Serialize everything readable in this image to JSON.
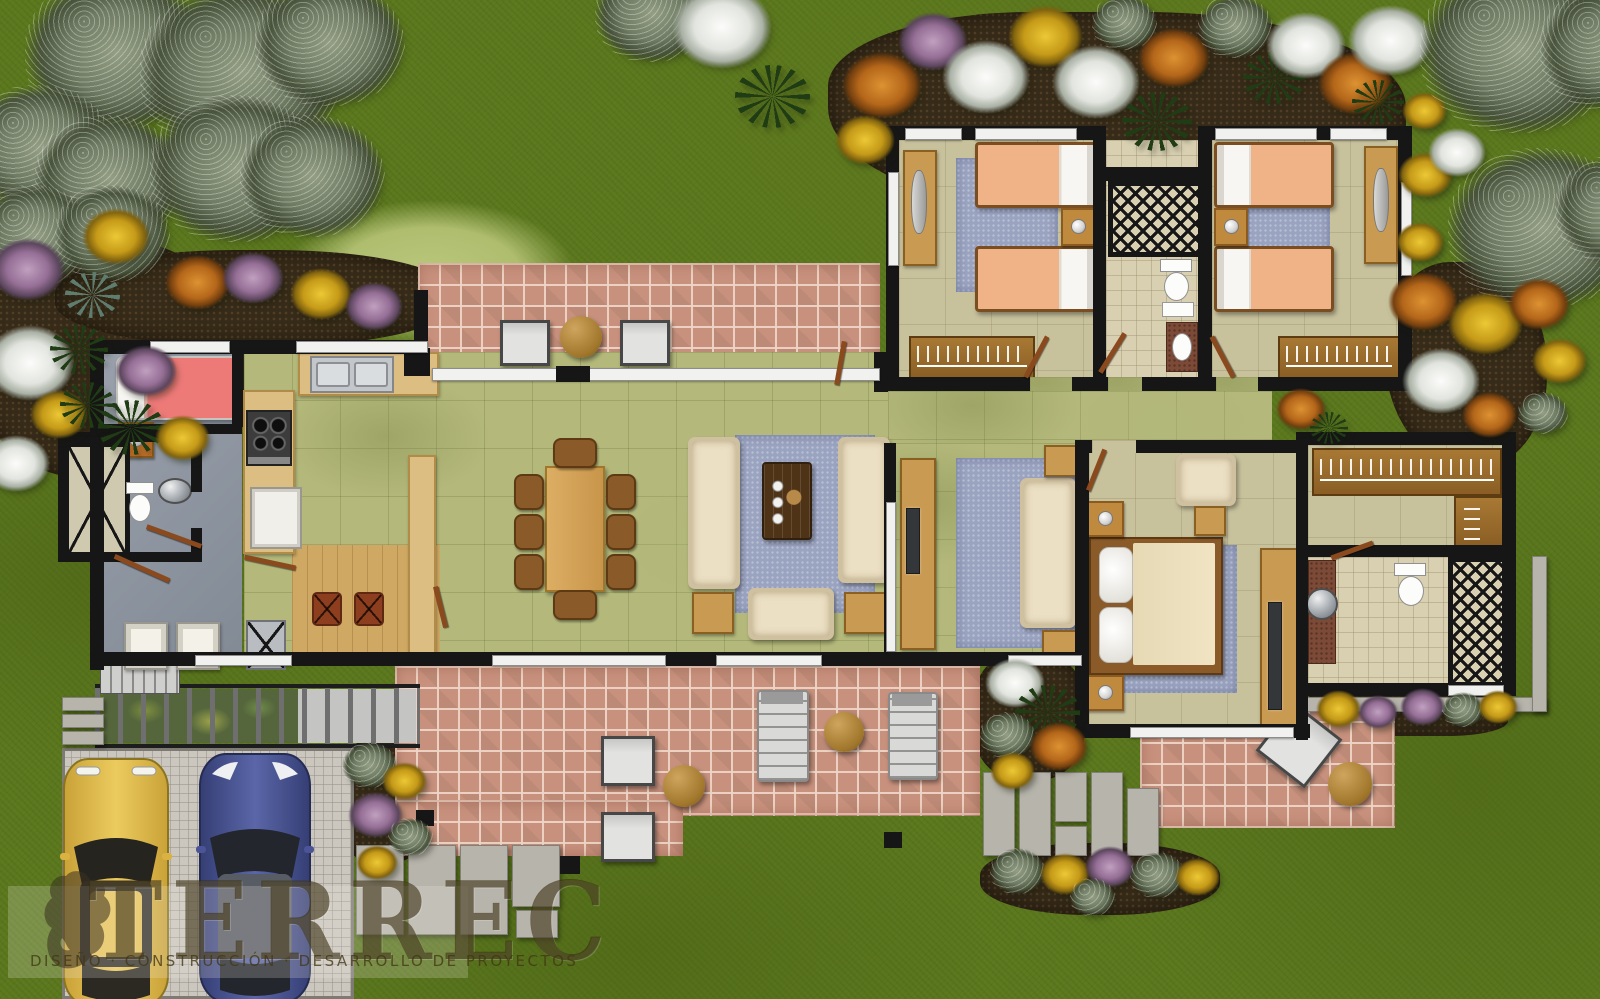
{
  "logo": {
    "title": "TERREC",
    "subtitle": "Diseño · Construcción · Desarrollo de Proyectos"
  },
  "palette": {
    "grass": "#5d7a1f",
    "grass_dark": "#4a6315",
    "hill": "#b2c173",
    "soil": "#362a18",
    "sage": "#75816a",
    "white_bloom": "#eceeea",
    "orange_bloom": "#c1771f",
    "yellow_bloom": "#d3a91d",
    "purple_bloom": "#a480a6",
    "palm": "#1f3c14",
    "wall": "#161616",
    "brick": "#c7917d",
    "mortar": "#ead0c0",
    "tile": "#b4b97b",
    "khaki": "#c7c19c",
    "bath": "#d9d0b2",
    "grayfloor": "#8e95a0",
    "wood": "#c89a52",
    "wood_dark": "#8a5a28",
    "closet_wood": "#9c6c30",
    "counter": "#ddbe82",
    "rug": "#9aa3c0",
    "sofa": "#ece0c4",
    "bed_peach": "#f0b287",
    "bed_pink": "#ee7a78",
    "bed_cream": "#f0e4c4",
    "steel": "#c3c6ca",
    "chair_gray": "#d2d2d2",
    "drive": "#cbc7bf",
    "paver": "#b7b4ac",
    "car_yellow": "#e2bc4a",
    "car_blue": "#4a5596",
    "logo_ink": "#3e3014"
  },
  "flora": [
    [
      25,
      -25,
      185,
      "sage"
    ],
    [
      140,
      -15,
      205,
      "sage"
    ],
    [
      255,
      -20,
      150,
      "sage"
    ],
    [
      -35,
      85,
      150,
      "sage"
    ],
    [
      35,
      115,
      150,
      "sage"
    ],
    [
      150,
      95,
      175,
      "sage"
    ],
    [
      240,
      115,
      145,
      "sage"
    ],
    [
      -25,
      185,
      120,
      "sage"
    ],
    [
      55,
      185,
      115,
      "sage"
    ],
    [
      595,
      -35,
      115,
      "sage"
    ],
    [
      672,
      -15,
      100,
      "white"
    ],
    [
      735,
      65,
      75,
      "palm"
    ],
    [
      842,
      52,
      80,
      "orange"
    ],
    [
      835,
      115,
      60,
      "yellow"
    ],
    [
      898,
      12,
      70,
      "purple"
    ],
    [
      942,
      40,
      88,
      "white"
    ],
    [
      1008,
      5,
      75,
      "yellow"
    ],
    [
      1052,
      45,
      88,
      "white"
    ],
    [
      1092,
      -5,
      65,
      "sage"
    ],
    [
      1122,
      92,
      70,
      "palm"
    ],
    [
      1138,
      28,
      72,
      "orange"
    ],
    [
      1198,
      -5,
      75,
      "sage"
    ],
    [
      1243,
      52,
      62,
      "palm"
    ],
    [
      1266,
      12,
      80,
      "white"
    ],
    [
      1318,
      52,
      75,
      "orange"
    ],
    [
      1348,
      5,
      85,
      "white"
    ],
    [
      1352,
      80,
      52,
      "palm"
    ],
    [
      1402,
      92,
      45,
      "yellow"
    ],
    [
      1398,
      152,
      55,
      "yellow"
    ],
    [
      1428,
      128,
      58,
      "white"
    ],
    [
      1396,
      222,
      48,
      "yellow"
    ],
    [
      1420,
      -35,
      200,
      "sage"
    ],
    [
      1540,
      -15,
      150,
      "sage"
    ],
    [
      1448,
      148,
      190,
      "sage"
    ],
    [
      1555,
      155,
      130,
      "sage"
    ],
    [
      1388,
      272,
      70,
      "orange"
    ],
    [
      1448,
      292,
      75,
      "yellow"
    ],
    [
      1508,
      278,
      62,
      "orange"
    ],
    [
      1532,
      338,
      55,
      "yellow"
    ],
    [
      1402,
      348,
      78,
      "white"
    ],
    [
      1462,
      392,
      55,
      "orange"
    ],
    [
      1518,
      392,
      50,
      "sage"
    ],
    [
      1276,
      388,
      50,
      "orange"
    ],
    [
      1310,
      412,
      38,
      "palm"
    ],
    [
      82,
      208,
      68,
      "yellow"
    ],
    [
      -10,
      238,
      75,
      "purple"
    ],
    [
      165,
      255,
      65,
      "orange"
    ],
    [
      65,
      272,
      55,
      "agave"
    ],
    [
      222,
      252,
      62,
      "purple"
    ],
    [
      290,
      268,
      62,
      "yellow"
    ],
    [
      345,
      282,
      58,
      "purple"
    ],
    [
      -15,
      325,
      90,
      "white"
    ],
    [
      50,
      325,
      58,
      "palm"
    ],
    [
      115,
      345,
      62,
      "purple"
    ],
    [
      30,
      390,
      58,
      "yellow"
    ],
    [
      98,
      400,
      66,
      "palm"
    ],
    [
      -18,
      435,
      68,
      "white"
    ],
    [
      155,
      415,
      55,
      "yellow"
    ],
    [
      60,
      382,
      55,
      "palm"
    ],
    [
      342,
      742,
      55,
      "sage"
    ],
    [
      382,
      762,
      45,
      "yellow"
    ],
    [
      348,
      792,
      55,
      "purple"
    ],
    [
      388,
      818,
      45,
      "sage"
    ],
    [
      356,
      845,
      42,
      "yellow"
    ],
    [
      985,
      658,
      60,
      "white"
    ],
    [
      1015,
      685,
      65,
      "palm"
    ],
    [
      980,
      712,
      55,
      "sage"
    ],
    [
      1030,
      722,
      58,
      "orange"
    ],
    [
      990,
      752,
      45,
      "yellow"
    ],
    [
      990,
      848,
      55,
      "sage"
    ],
    [
      1040,
      853,
      50,
      "yellow"
    ],
    [
      1085,
      846,
      50,
      "purple"
    ],
    [
      1130,
      852,
      55,
      "sage"
    ],
    [
      1175,
      858,
      45,
      "yellow"
    ],
    [
      1070,
      878,
      45,
      "sage"
    ],
    [
      1316,
      690,
      45,
      "yellow"
    ],
    [
      1358,
      695,
      40,
      "purple"
    ],
    [
      1400,
      688,
      45,
      "purple"
    ],
    [
      1442,
      692,
      42,
      "sage"
    ],
    [
      1478,
      690,
      40,
      "yellow"
    ]
  ]
}
